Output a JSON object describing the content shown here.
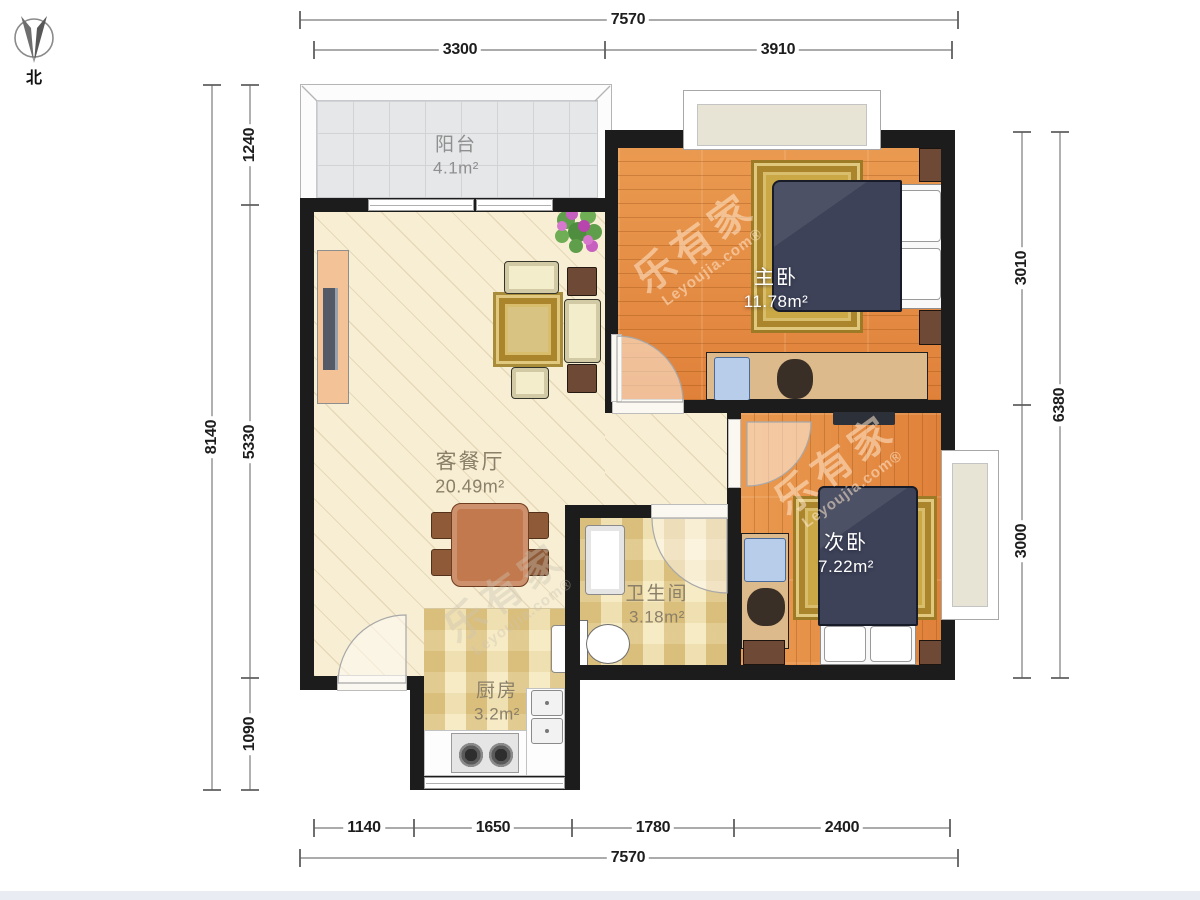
{
  "compass": {
    "label": "北"
  },
  "rooms": [
    {
      "name": "阳台",
      "area": "4.1m²"
    },
    {
      "name": "主卧",
      "area": "11.78m²"
    },
    {
      "name": "客餐厅",
      "area": "20.49m²"
    },
    {
      "name": "次卧",
      "area": "7.22m²"
    },
    {
      "name": "卫生间",
      "area": "3.18m²"
    },
    {
      "name": "厨房",
      "area": "3.2m²"
    }
  ],
  "dimensions": {
    "top_total": "7570",
    "top_segments": [
      "3300",
      "3910"
    ],
    "bottom_segments": [
      "1140",
      "1650",
      "1780",
      "2400"
    ],
    "bottom_total": "7570",
    "left_total": "8140",
    "left_segments": [
      "1240",
      "5330",
      "1090"
    ],
    "right_segments": [
      "3010",
      "3000"
    ],
    "right_total": "6380"
  },
  "watermark": {
    "cn": "乐有家",
    "en": "Leyoujia.com®"
  },
  "colors": {
    "wall": "#1c1c1c",
    "wood_floor": "#e2873b",
    "living_floor": "#f7eed4",
    "tile_floor": "#eedfae",
    "balcony_floor": "#e6e7e9",
    "bed": "#3d4258",
    "rug": "#c9a845"
  }
}
